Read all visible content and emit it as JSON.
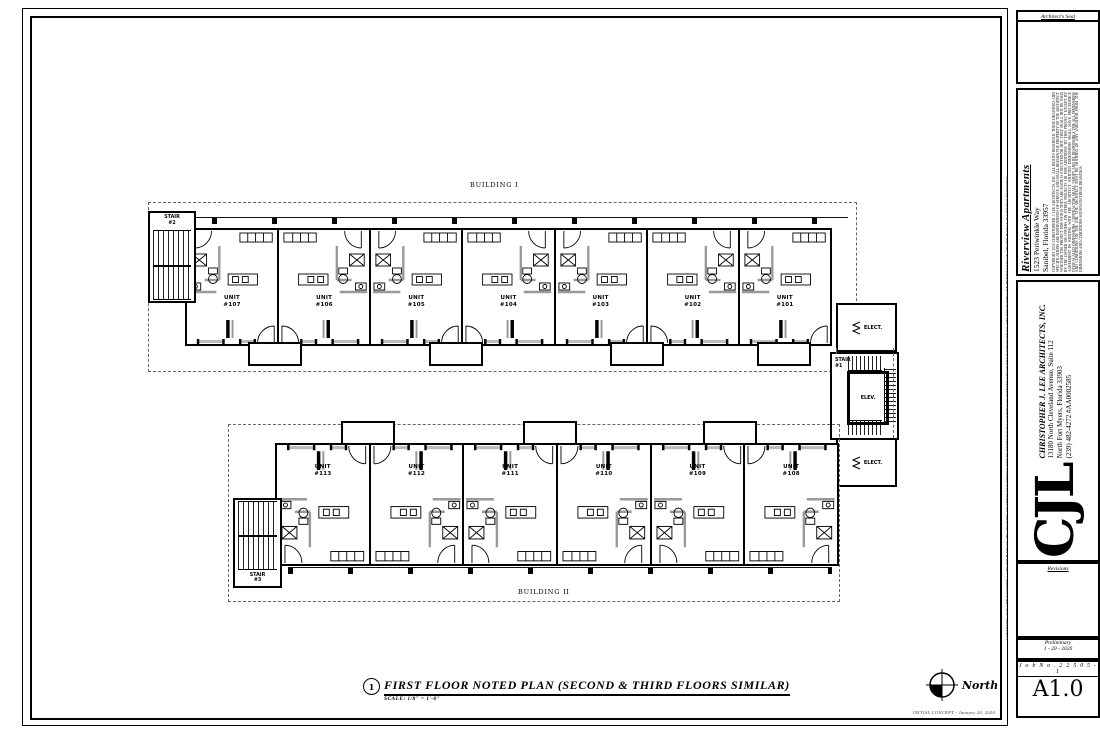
{
  "sheet": {
    "callout_number": "1",
    "title": "FIRST FLOOR NOTED PLAN (SECOND & THIRD FLOORS SIMILAR)",
    "scale": "SCALE: 1/8\" = 1'-0\"",
    "north_label": "North",
    "concept_note": "INITIAL CONCEPT - January 20, 2020"
  },
  "plan": {
    "unit_word": "UNIT",
    "building1": {
      "label": "BUILDING I",
      "units": [
        "#107",
        "#106",
        "#105",
        "#104",
        "#103",
        "#102",
        "#101"
      ]
    },
    "building2": {
      "label": "BUILDING II",
      "units": [
        "#113",
        "#112",
        "#111",
        "#110",
        "#109",
        "#108"
      ]
    },
    "stair_word": "STAIR",
    "stair1_num": "#1",
    "stair2_num": "#2",
    "stair3_num": "#3",
    "elevator_label": "ELEV.",
    "electrical_label": "ELECT."
  },
  "titleblock": {
    "seal_label": "Architect's Seal",
    "project": {
      "name": "Riverview Apartments",
      "address_line1": "1523 Periwinkle Way",
      "address_line2": "Sanibel, Florida 33957",
      "fine_print": "COPYRIGHT 2020 CHRISTOPHER J. LEE ARCHITECTS, INC. ALL RIGHTS RESERVED. THESE DRAWINGS AND SPECIFICATIONS ARE INSTRUMENTS OF SERVICE AND SHALL REMAIN THE PROPERTY OF THE ARCHITECT WHETHER THE PROJECT FOR WHICH THEY ARE MADE IS EXECUTED OR NOT. THEY SHALL NOT BE USED BY THE OWNER OR OTHERS ON OTHER PROJECTS OR FOR ADDITIONS TO THIS PROJECT EXCEPT BY AGREEMENT IN WRITING WITH THE ARCHITECT. WRITTEN DIMENSIONS SHALL HAVE PRECEDENCE OVER SCALED DIMENSIONS. CONTRACTOR SHALL VERIFY AND BE RESPONSIBLE FOR ALL DIMENSIONS AND CONDITIONS ON THE JOB. THE ARCHITECT MUST BE NOTIFIED OF ANY VARIATION FROM THE DIMENSIONS AND CONDITIONS SHOWN ON THESE DRAWINGS."
    },
    "architect": {
      "logo": "CJL",
      "name": "CHRISTOPHER J. LEE ARCHITECTS, INC.",
      "address_line1": "13180 North Cleveland Avenue, Suite 112",
      "address_line2": "North Fort Myers, Florida 33903",
      "phone_license": "(239) 482-4272    #AA0002585"
    },
    "revisions_label": "Revisions",
    "status_line1": "Preliminary",
    "status_line2": "1 - 20 - 2020",
    "job_number": "J o b   N o .   2 2 5 0 5 - 1",
    "sheet_number": "A1.0",
    "edge_microtext": "COPYRIGHT 2020 CHRISTOPHER J. LEE ARCHITECTS, INC.  NO PART OF THESE DOCUMENTS MAY BE REPRODUCED, STORED OR TRANSMITTED IN ANY FORM WITHOUT THE PRIOR WRITTEN PERMISSION OF THE ARCHITECT.  ALL RIGHTS RESERVED."
  }
}
